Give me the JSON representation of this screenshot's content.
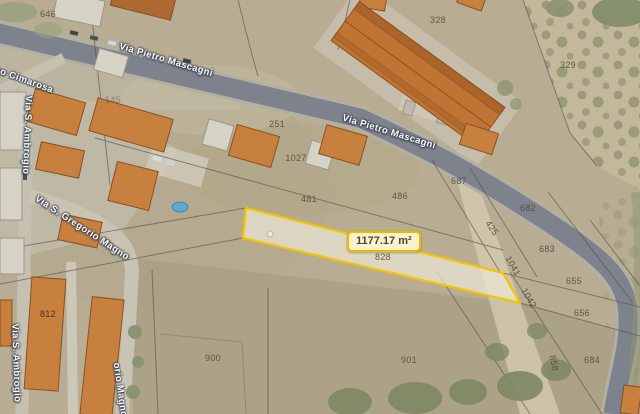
{
  "map": {
    "area_measurement": "1177.17 m²",
    "streets": [
      {
        "label": "Via Pietro Mascagni"
      },
      {
        "label": "Via Pietro Mascagni"
      },
      {
        "label": "co Cimarosa"
      },
      {
        "label": "Via S. Ambrogio"
      },
      {
        "label": "Via S. Ambrogio"
      },
      {
        "label": "Via S. Gregorio Magno"
      },
      {
        "label": "orio Magno"
      }
    ],
    "parcels": [
      {
        "label": "646"
      },
      {
        "label": "328"
      },
      {
        "label": "329"
      },
      {
        "label": "145"
      },
      {
        "label": "251"
      },
      {
        "label": "1027"
      },
      {
        "label": "481"
      },
      {
        "label": "486"
      },
      {
        "label": "687"
      },
      {
        "label": "682"
      },
      {
        "label": "425"
      },
      {
        "label": "683"
      },
      {
        "label": "1041"
      },
      {
        "label": "655"
      },
      {
        "label": "1042"
      },
      {
        "label": "656"
      },
      {
        "label": "828"
      },
      {
        "label": "812"
      },
      {
        "label": "900"
      },
      {
        "label": "901"
      },
      {
        "label": "858"
      },
      {
        "label": "684"
      }
    ],
    "colors": {
      "highlight_outline": "#f2c500",
      "area_badge_bg": "#fbf2cc",
      "area_badge_border": "#edb800",
      "building_orange": "#c8803f",
      "road_gray": "#7d828c",
      "terrain_tan": "#b8ad93",
      "pool_blue": "#5fa8cc"
    }
  }
}
